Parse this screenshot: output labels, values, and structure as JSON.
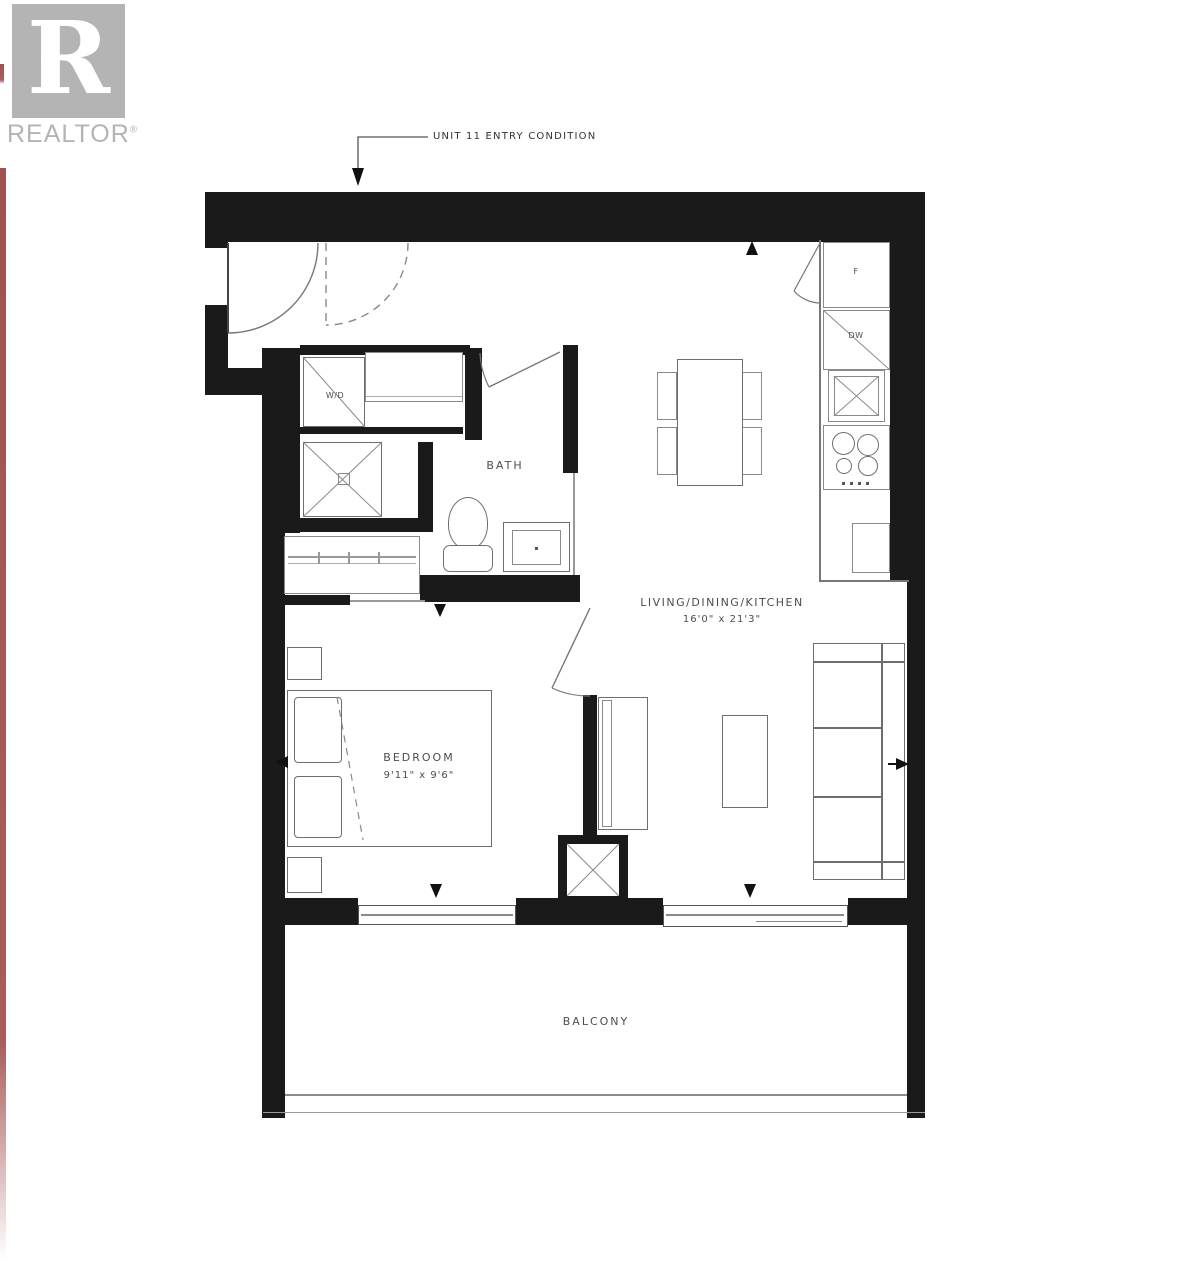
{
  "logo": {
    "letter": "R",
    "brand": "REALTOR",
    "reg": "®"
  },
  "annotation": {
    "entry_note": "UNIT 11 ENTRY CONDITION"
  },
  "rooms": {
    "living": {
      "name": "LIVING/DINING/KITCHEN",
      "dims": "16'0\" x 21'3\""
    },
    "bedroom": {
      "name": "BEDROOM",
      "dims": "9'11\" x 9'6\""
    },
    "bath": {
      "name": "BATH"
    },
    "balcony": {
      "name": "BALCONY"
    },
    "laundry": {
      "label": "W/D"
    }
  },
  "appliances": {
    "fridge": "F",
    "dishwasher": "DW"
  },
  "colors": {
    "wall": "#1a1a1a",
    "line_gray": "#8a8a8a",
    "fixture_gray": "#6e6e6e",
    "label_gray": "#4d4d4d",
    "logo_gray": "#b4b4b4",
    "edge_red": "#a85c5c",
    "background": "#ffffff"
  }
}
